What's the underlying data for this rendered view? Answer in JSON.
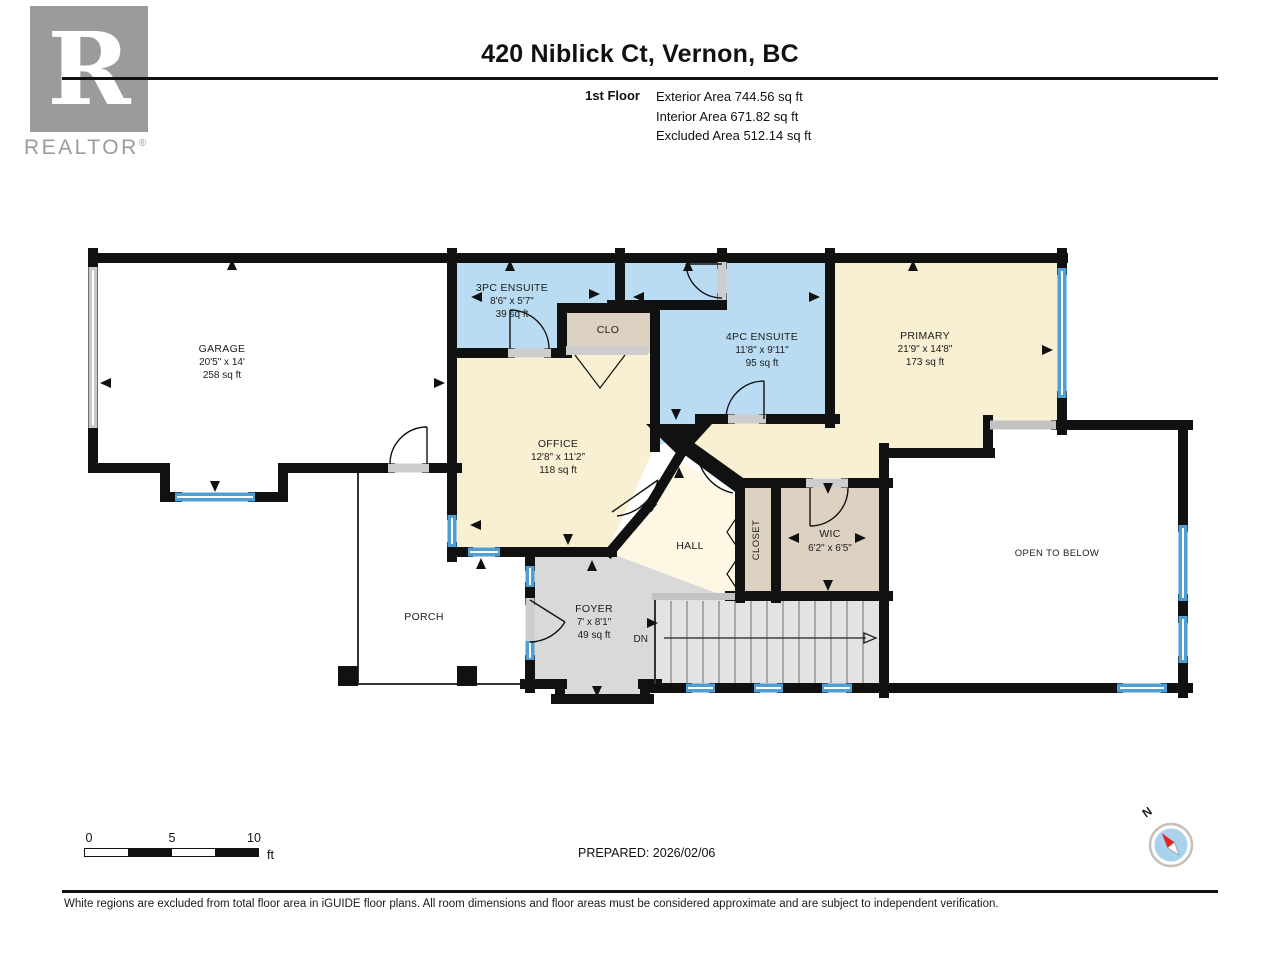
{
  "header": {
    "title": "420 Niblick Ct, Vernon, BC",
    "floor_label": "1st Floor",
    "areas": [
      "Exterior Area 744.56 sq ft",
      "Interior Area 671.82 sq ft",
      "Excluded Area 512.14 sq ft"
    ]
  },
  "logo": {
    "letter": "R",
    "brand": "REALTOR",
    "reg": "®"
  },
  "rooms": {
    "garage": {
      "name": "GARAGE",
      "dims": "20'5\" x 14'",
      "area": "258 sq ft"
    },
    "ensuite3": {
      "name": "3PC ENSUITE",
      "dims": "8'6\" x 5'7\"",
      "area": "39 sq ft"
    },
    "clo": {
      "name": "CLO"
    },
    "ensuite4": {
      "name": "4PC ENSUITE",
      "dims": "11'8\" x 9'11\"",
      "area": "95 sq ft"
    },
    "primary": {
      "name": "PRIMARY",
      "dims": "21'9\" x 14'8\"",
      "area": "173 sq ft"
    },
    "office": {
      "name": "OFFICE",
      "dims": "12'8\" x 11'2\"",
      "area": "118 sq ft"
    },
    "hall": {
      "name": "HALL"
    },
    "closet": {
      "name": "CLOSET"
    },
    "wic": {
      "name": "WIC",
      "dims": "6'2\" x 6'5\""
    },
    "open_to_below": {
      "name": "OPEN TO BELOW"
    },
    "porch": {
      "name": "PORCH"
    },
    "foyer": {
      "name": "FOYER",
      "dims": "7' x 8'1\"",
      "area": "49 sq ft"
    },
    "stairs": {
      "label": "DN"
    }
  },
  "scale_bar": {
    "ticks": [
      "0",
      "5",
      "10"
    ],
    "unit": "ft"
  },
  "compass": {
    "north_label": "N"
  },
  "footer": {
    "prepared": "PREPARED: 2026/02/06",
    "disclaimer": "White regions are excluded from total floor area in iGUIDE floor plans. All room dimensions and floor areas must be considered approximate and are subject to independent verification."
  },
  "colors": {
    "wall": "#111111",
    "ensuite_floor": "#b9dcf2",
    "bedroom_floor": "#f9efd2",
    "hall_floor": "#fdf7e3",
    "closet_floor": "#ddd2c2",
    "foyer_floor": "#d9d9d9",
    "stairs_floor": "#e3e3e3",
    "window_blue": "#4f9fd4",
    "door_sill_gray": "#cdcdcd",
    "excluded_floor": "#ffffff",
    "logo_gray": "#9b9b9b",
    "compass_red": "#e8211d",
    "compass_blue": "#a9d3ec"
  }
}
